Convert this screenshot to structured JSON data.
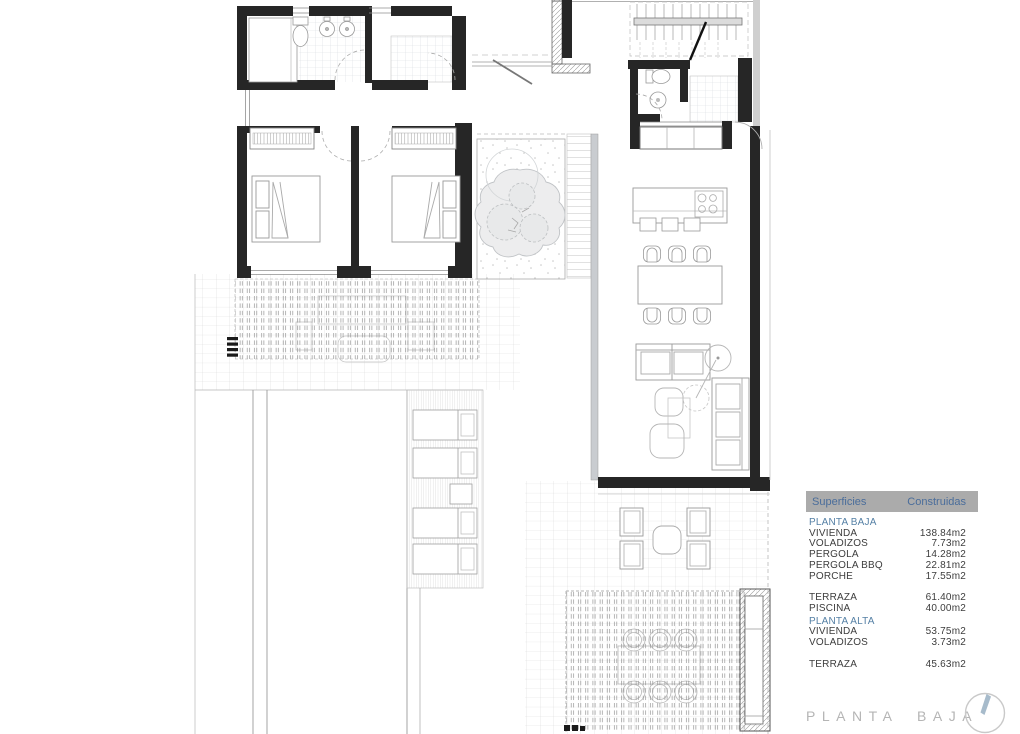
{
  "plan": {
    "title": "PLANTA BAJA",
    "compass_icon": "north-compass-icon"
  },
  "legend": {
    "header": {
      "superficies": "Superficies",
      "construidas": "Construidas"
    },
    "rows": [
      {
        "label": "PLANTA BAJA",
        "value": "",
        "section": true
      },
      {
        "label": "VIVIENDA",
        "value": "138.84m2"
      },
      {
        "label": "VOLADIZOS",
        "value": "7.73m2"
      },
      {
        "label": "PERGOLA",
        "value": "14.28m2"
      },
      {
        "label": "PERGOLA BBQ",
        "value": "22.81m2"
      },
      {
        "label": "PORCHE",
        "value": "17.55m2"
      },
      {
        "label": "TERRAZA",
        "value": "61.40m2"
      },
      {
        "label": "PISCINA",
        "value": "40.00m2"
      },
      {
        "label": "PLANTA ALTA",
        "value": "",
        "section": true
      },
      {
        "label": "VIVIENDA",
        "value": "53.75m2"
      },
      {
        "label": "VOLADIZOS",
        "value": "3.73m2"
      },
      {
        "label": "TERRAZA",
        "value": "45.63m2"
      }
    ]
  },
  "colors": {
    "header_bg": "#ababab",
    "header_text": "#4a6d9b",
    "section_text": "#5580a5",
    "row_text": "#3d3d3d",
    "title_gray": "#b5b5b5",
    "wall": "#262626",
    "compass_needle": "#a7bbcb"
  }
}
